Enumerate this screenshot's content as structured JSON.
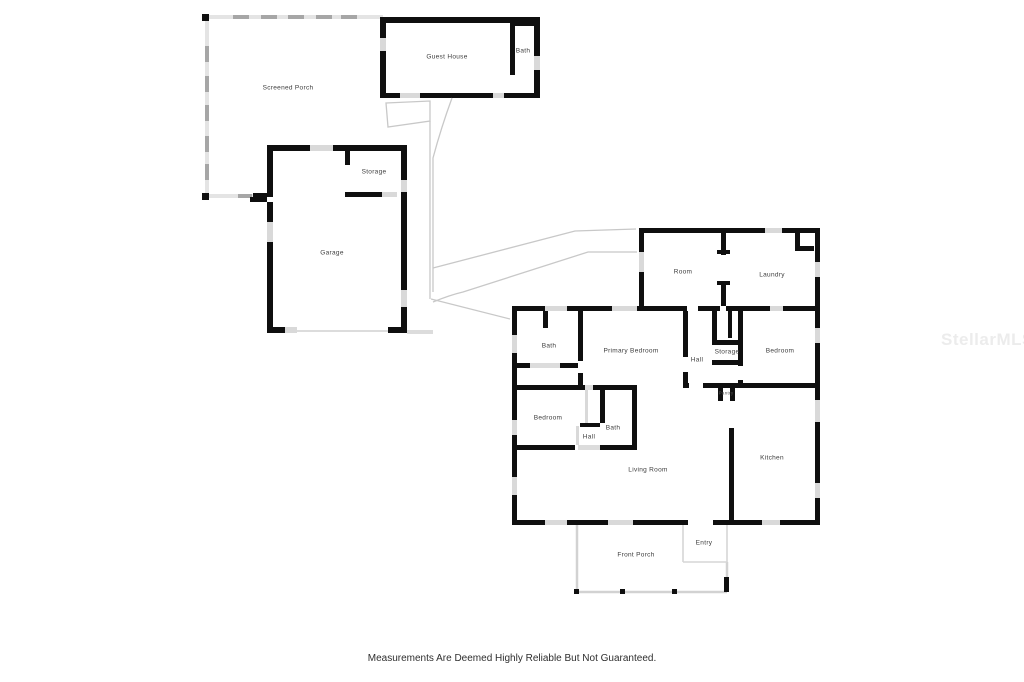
{
  "floorplan": {
    "disclaimer": "Measurements Are Deemed Highly Reliable But Not Guaranteed.",
    "watermark": "StellarMLS",
    "colors": {
      "wall": "#0f0f0f",
      "window": "#d9d9d9",
      "screen_wall": "#e4e4e4",
      "walkway_line": "#c8c8c8",
      "label_text": "#3d3d3d",
      "watermark_text": "#ececec",
      "background": "#ffffff"
    },
    "rooms": [
      {
        "id": "screened-porch",
        "label": "Screened Porch"
      },
      {
        "id": "guest-house",
        "label": "Guest House"
      },
      {
        "id": "guest-bath",
        "label": "Bath"
      },
      {
        "id": "garage-storage",
        "label": "Storage"
      },
      {
        "id": "garage",
        "label": "Garage"
      },
      {
        "id": "room",
        "label": "Room"
      },
      {
        "id": "laundry",
        "label": "Laundry"
      },
      {
        "id": "primary-bath",
        "label": "Bath"
      },
      {
        "id": "primary-bedroom",
        "label": "Primary Bedroom"
      },
      {
        "id": "hall",
        "label": "Hall"
      },
      {
        "id": "storage",
        "label": "Storage"
      },
      {
        "id": "bedroom-right",
        "label": "Bedroom"
      },
      {
        "id": "bedroom-left",
        "label": "Bedroom"
      },
      {
        "id": "hall-small",
        "label": "Hall"
      },
      {
        "id": "bath-small",
        "label": "Bath"
      },
      {
        "id": "pantry",
        "label": "Pantry"
      },
      {
        "id": "living-room",
        "label": "Living Room"
      },
      {
        "id": "kitchen",
        "label": "Kitchen"
      },
      {
        "id": "entry",
        "label": "Entry"
      },
      {
        "id": "front-porch",
        "label": "Front Porch"
      }
    ]
  }
}
